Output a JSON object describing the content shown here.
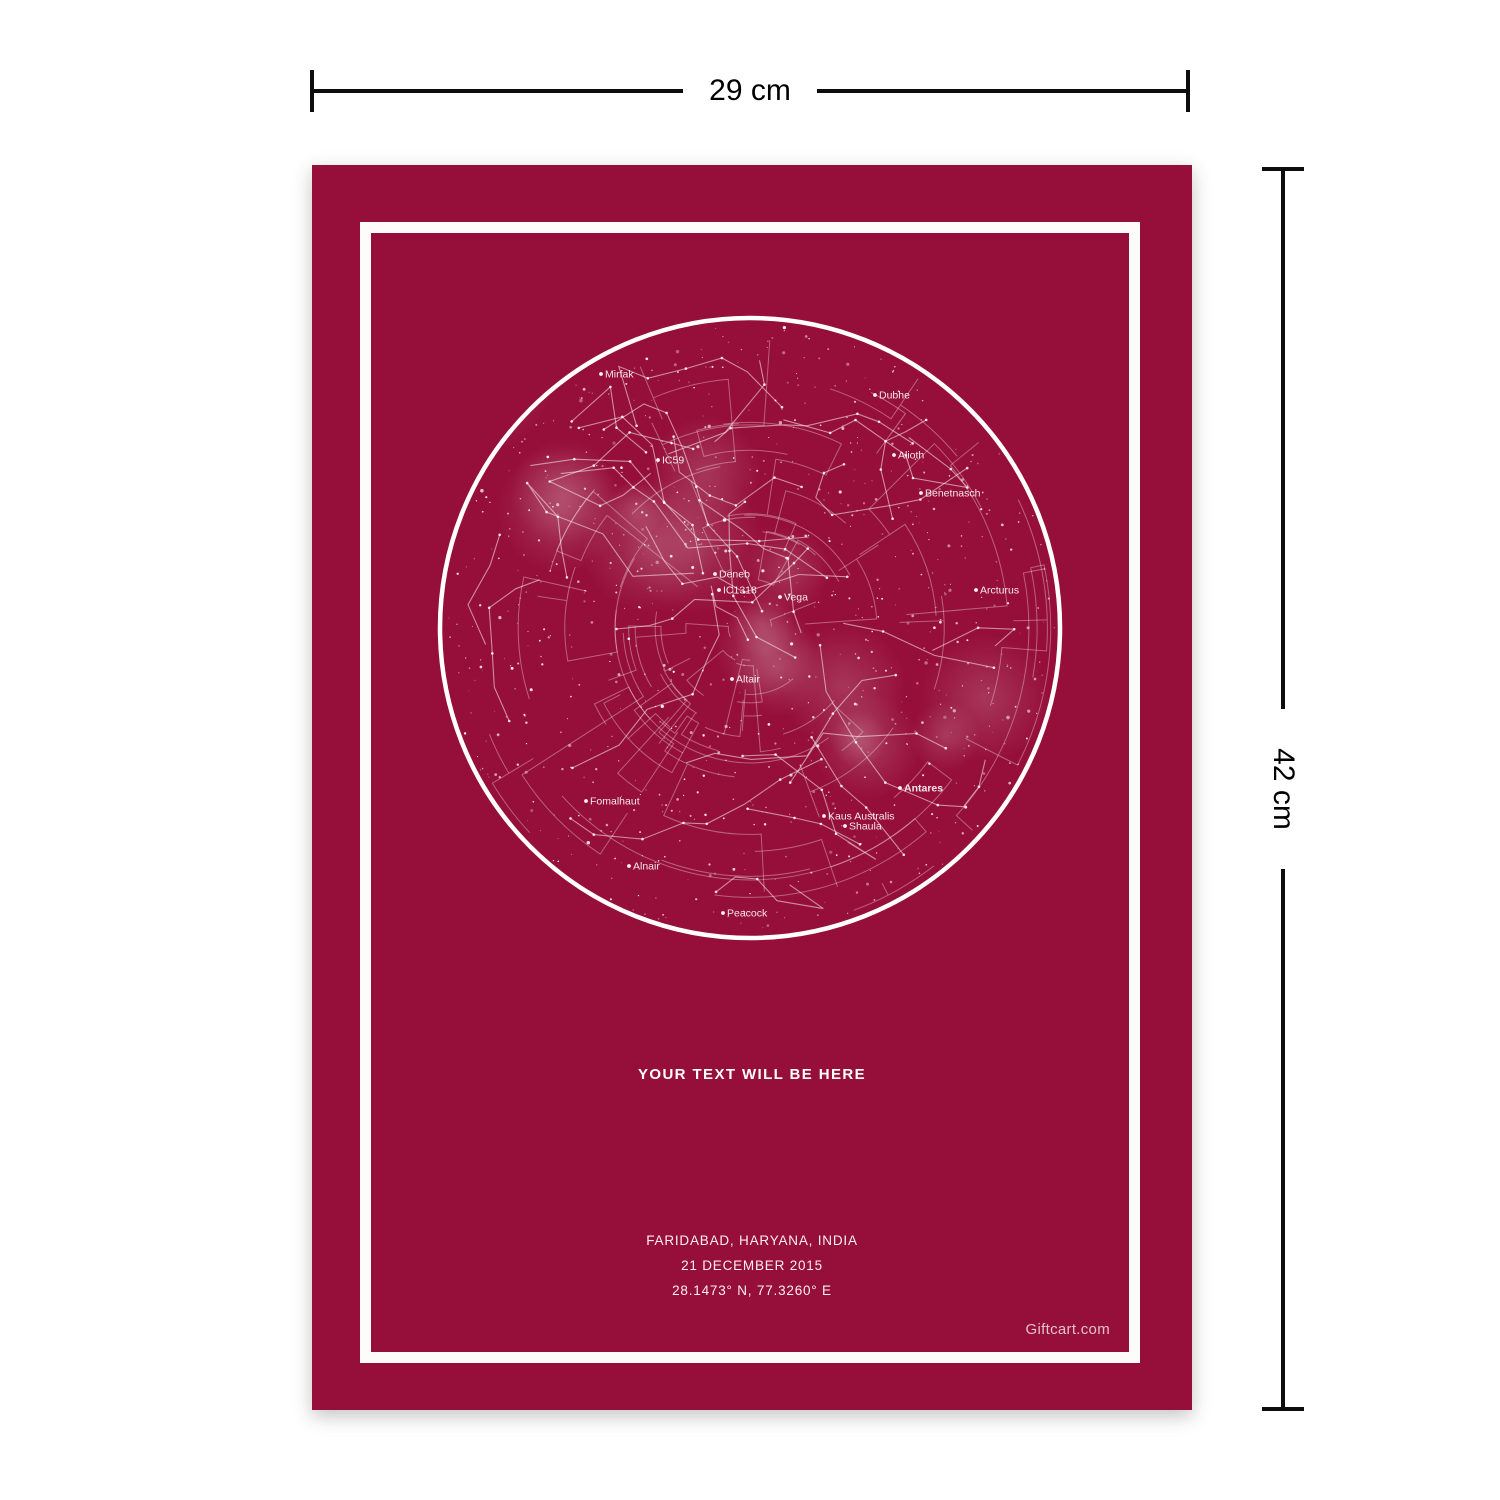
{
  "dimensions": {
    "width_label": "29 cm",
    "height_label": "42 cm"
  },
  "poster": {
    "bg_color": "#960f3b",
    "frame_color": "#fdfcfa",
    "custom_text": "YOUR TEXT WILL BE HERE",
    "location_line1": "FARIDABAD, HARYANA, INDIA",
    "location_line2": "21 DECEMBER 2015",
    "location_line3": "28.1473° N, 77.3260° E",
    "brand": "Giftcart.com"
  },
  "star_map": {
    "ring_color": "#ffffff",
    "star_color": "#ffffff",
    "labels": [
      {
        "name": "Mirfak",
        "x": 181,
        "y": 76
      },
      {
        "name": "Dubhe",
        "x": 455,
        "y": 97
      },
      {
        "name": "IC59",
        "x": 238,
        "y": 162
      },
      {
        "name": "Alioth",
        "x": 474,
        "y": 157
      },
      {
        "name": "Benetnasch",
        "x": 501,
        "y": 195
      },
      {
        "name": "Deneb",
        "x": 295,
        "y": 276
      },
      {
        "name": "IC1318",
        "x": 299,
        "y": 292
      },
      {
        "name": "Vega",
        "x": 360,
        "y": 299
      },
      {
        "name": "Arcturus",
        "x": 556,
        "y": 292
      },
      {
        "name": "Altair",
        "x": 312,
        "y": 381
      },
      {
        "name": "Fomalhaut",
        "x": 166,
        "y": 503
      },
      {
        "name": "Antares",
        "x": 480,
        "y": 490,
        "bold": true
      },
      {
        "name": "Kaus Australis",
        "x": 404,
        "y": 518
      },
      {
        "name": "Shaula",
        "x": 425,
        "y": 528
      },
      {
        "name": "Alnair",
        "x": 209,
        "y": 568
      },
      {
        "name": "Peacock",
        "x": 303,
        "y": 615
      }
    ]
  }
}
